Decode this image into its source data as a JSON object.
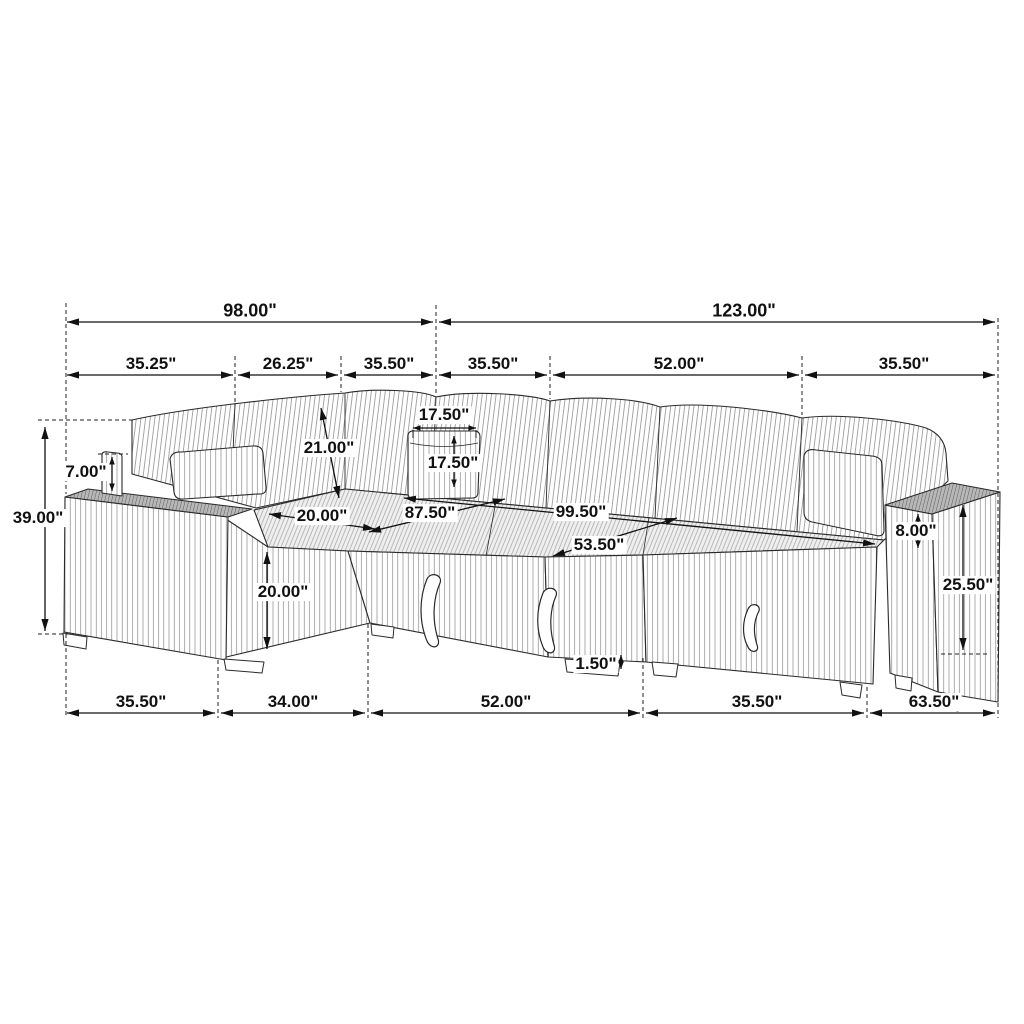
{
  "figure": {
    "type": "furniture-dimension-diagram",
    "subject": "sectional sleeper sofa line drawing",
    "units_symbol": "\"",
    "colors": {
      "line": "#2a2a2a",
      "dimension_line": "#111111",
      "arm_top_shade": "#b7b7b7",
      "deck_shade": "#f0f0f0",
      "background": "#ffffff"
    }
  },
  "dims": {
    "r1_98": "98.00\"",
    "r1_123": "123.00\"",
    "r2_3525": "35.25\"",
    "r2_2625": "26.25\"",
    "r2_355a": "35.50\"",
    "r2_355b": "35.50\"",
    "r2_52": "52.00\"",
    "r2_355c": "35.50\"",
    "b_355a": "35.50\"",
    "b_34": "34.00\"",
    "b_52": "52.00\"",
    "b_355b": "35.50\"",
    "b_635": "63.50\"",
    "l_39": "39.00\"",
    "l_7": "7.00\"",
    "l_20": "20.00\"",
    "i_21": "21.00\"",
    "i_175w": "17.50\"",
    "i_175h": "17.50\"",
    "i_20": "20.00\"",
    "i_875": "87.50\"",
    "i_995": "99.50\"",
    "i_535": "53.50\"",
    "rt_8": "8.00\"",
    "rt_255": "25.50\"",
    "rt_15": "1.50\""
  }
}
